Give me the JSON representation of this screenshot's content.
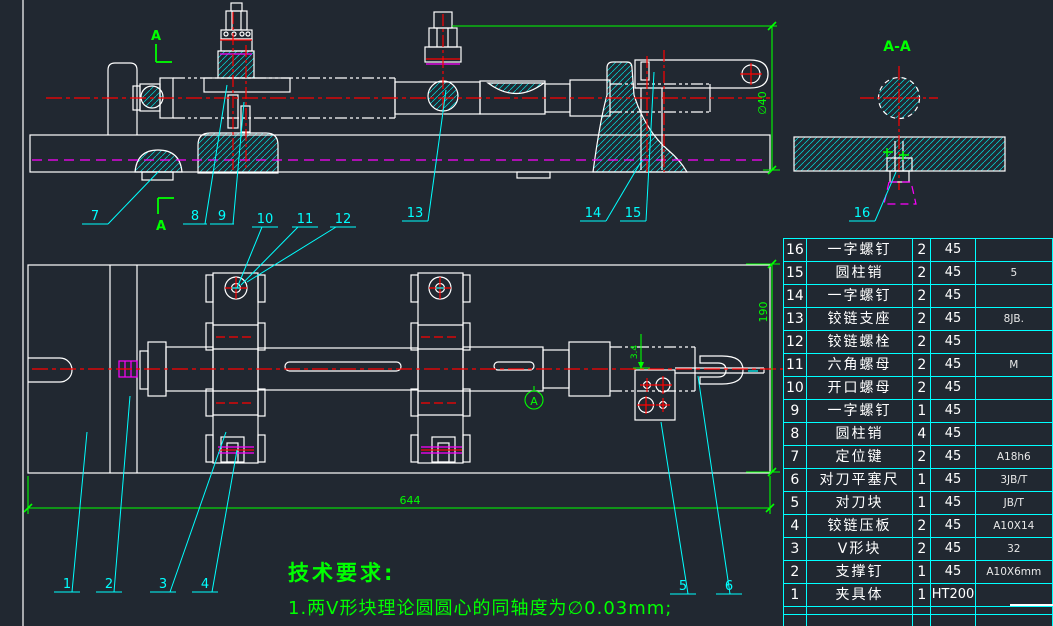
{
  "drawing": {
    "colors": {
      "background": "#212831",
      "outline": "#ffffff",
      "hatch_and_table": "#00ffff",
      "centerline": "#ff0000",
      "hidden_line": "#ff00ff",
      "annotation": "#00ff00"
    },
    "section_mark_top": "A",
    "section_mark_bottom": "A",
    "section_view_title": "A-A",
    "datum_label": "A",
    "leaders": {
      "front": [
        "7",
        "8",
        "9",
        "10",
        "11",
        "12",
        "13",
        "14",
        "15"
      ],
      "plan": [
        "1",
        "2",
        "3",
        "4",
        "5",
        "6"
      ],
      "section": "16"
    },
    "dimensions": {
      "front_height": "∅40",
      "plan_length": "644",
      "plan_depth": "190",
      "probe_offset": "3.4"
    }
  },
  "tech_requirements": {
    "title": "技术要求:",
    "line1": "1.两V形块理论圆圆心的同轴度为∅0.03mm;",
    "line2_clipped": "2.两V形块的V形面对夹具体底面的平行度为0.03mm;"
  },
  "bom": {
    "rows": [
      {
        "no": "16",
        "name": "一字螺钉",
        "qty": "2",
        "material": "45",
        "note": ""
      },
      {
        "no": "15",
        "name": "圆柱销",
        "qty": "2",
        "material": "45",
        "note": "5"
      },
      {
        "no": "14",
        "name": "一字螺钉",
        "qty": "2",
        "material": "45",
        "note": ""
      },
      {
        "no": "13",
        "name": "铰链支座",
        "qty": "2",
        "material": "45",
        "note": "8JB."
      },
      {
        "no": "12",
        "name": "铰链螺栓",
        "qty": "2",
        "material": "45",
        "note": ""
      },
      {
        "no": "11",
        "name": "六角螺母",
        "qty": "2",
        "material": "45",
        "note": "M"
      },
      {
        "no": "10",
        "name": "开口螺母",
        "qty": "2",
        "material": "45",
        "note": ""
      },
      {
        "no": "9",
        "name": "一字螺钉",
        "qty": "1",
        "material": "45",
        "note": ""
      },
      {
        "no": "8",
        "name": "圆柱销",
        "qty": "4",
        "material": "45",
        "note": ""
      },
      {
        "no": "7",
        "name": "定位键",
        "qty": "2",
        "material": "45",
        "note": "A18h6"
      },
      {
        "no": "6",
        "name": "对刀平塞尺",
        "qty": "1",
        "material": "45",
        "note": "3JB/T"
      },
      {
        "no": "5",
        "name": "对刀块",
        "qty": "1",
        "material": "45",
        "note": "JB/T"
      },
      {
        "no": "4",
        "name": "铰链压板",
        "qty": "2",
        "material": "45",
        "note": "A10X14"
      },
      {
        "no": "3",
        "name": "V形块",
        "qty": "2",
        "material": "45",
        "note": "32"
      },
      {
        "no": "2",
        "name": "支撑钉",
        "qty": "1",
        "material": "45",
        "note": "A10X6mm"
      },
      {
        "no": "1",
        "name": "夹具体",
        "qty": "1",
        "material": "HT200",
        "note": ""
      }
    ]
  }
}
